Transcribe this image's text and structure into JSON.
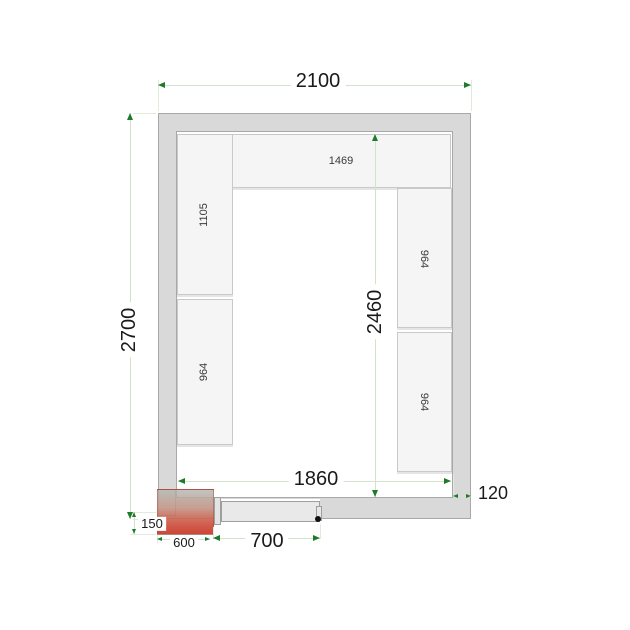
{
  "diagram": {
    "type": "cold-room-floor-plan",
    "dims": {
      "outer_width": "2100",
      "outer_height": "2700",
      "inner_width": "1860",
      "inner_height": "2460",
      "wall_thickness": "120",
      "door_width": "700",
      "cooling_unit_width": "600",
      "cooling_unit_protrusion": "150"
    },
    "shelves": {
      "top": "1469",
      "left_upper": "1105",
      "left_lower": "964",
      "right_upper": "964",
      "right_lower": "964"
    },
    "colors": {
      "wall": "#d9d9d9",
      "shelf": "#f5f5f5",
      "dimension_line": "#d2e2cc",
      "dimension_arrow": "#1e7b2c",
      "cooling_unit_red": "#cb3e2e",
      "door": "#e9e9e9"
    }
  }
}
